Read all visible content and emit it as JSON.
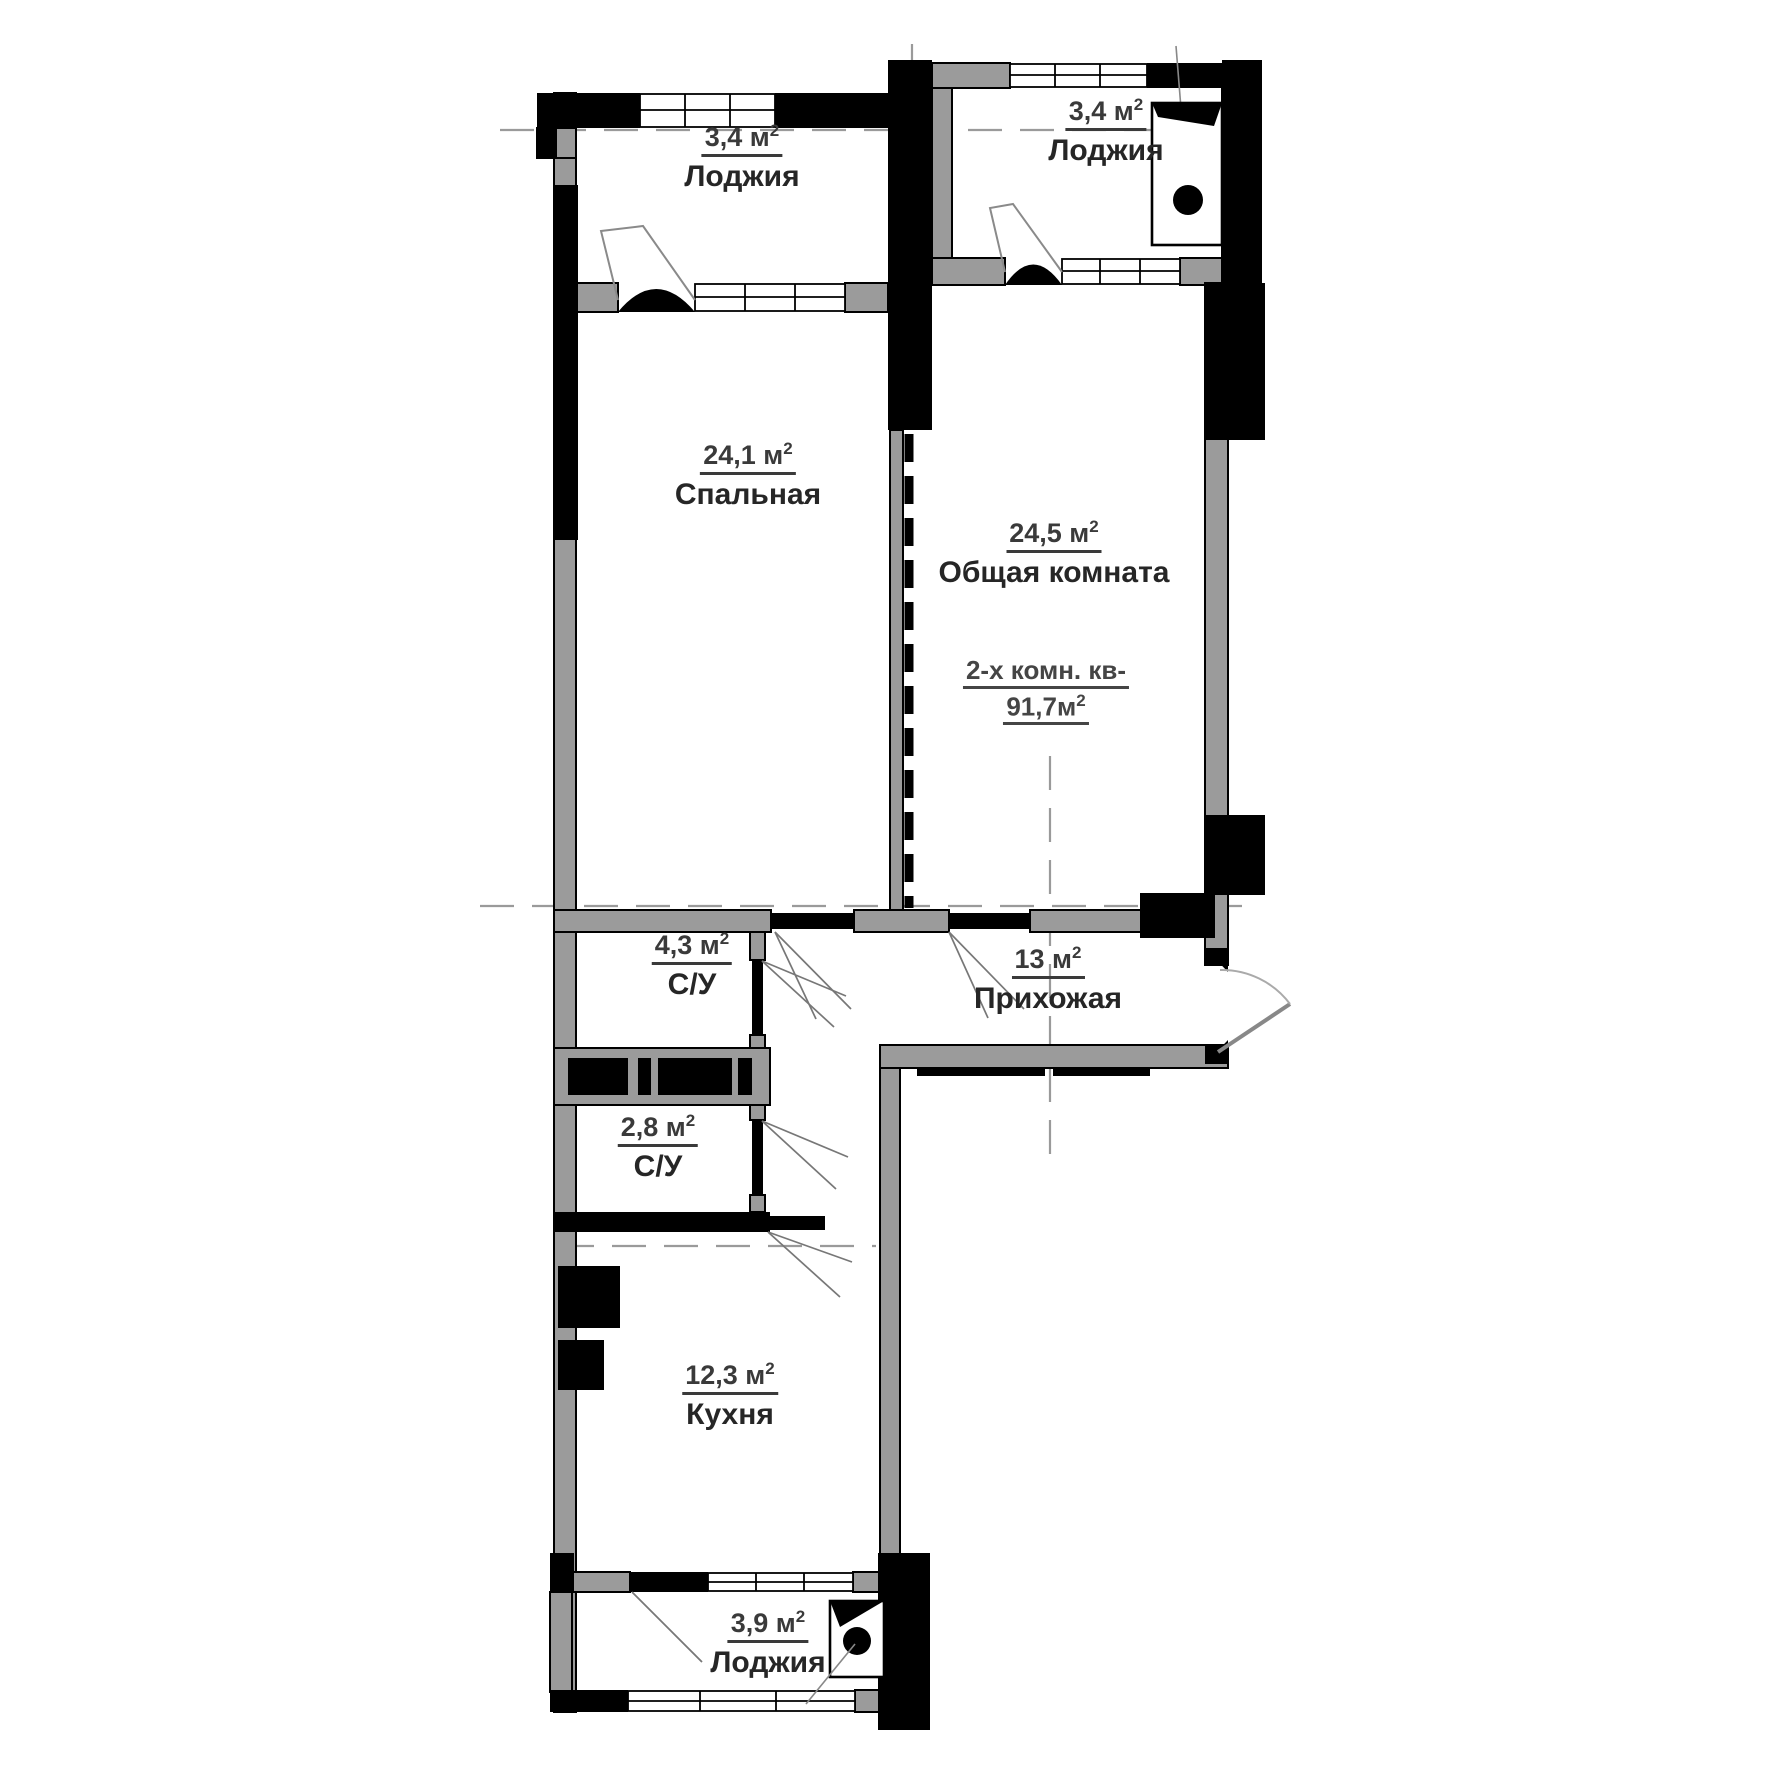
{
  "plan": {
    "colors": {
      "wall_gray": "#9b9b9b",
      "wall_black": "#000000",
      "thin_line": "#777777"
    },
    "apartment_summary": {
      "line1": "2-х комн. кв-",
      "area_label": "91,7м",
      "sup": "2"
    },
    "rooms": [
      {
        "id": "loggia-top-left",
        "area_label": "3,4 м",
        "sup": "2",
        "name": "Лоджия"
      },
      {
        "id": "loggia-top-right",
        "area_label": "3,4 м",
        "sup": "2",
        "name": "Лоджия"
      },
      {
        "id": "bedroom",
        "area_label": "24,1 м",
        "sup": "2",
        "name": "Спальная"
      },
      {
        "id": "living-room",
        "area_label": "24,5 м",
        "sup": "2",
        "name": "Общая комната"
      },
      {
        "id": "bathroom-1",
        "area_label": "4,3 м",
        "sup": "2",
        "name": "С/У"
      },
      {
        "id": "hallway",
        "area_label": "13 м",
        "sup": "2",
        "name": "Прихожая"
      },
      {
        "id": "bathroom-2",
        "area_label": "2,8 м",
        "sup": "2",
        "name": "С/У"
      },
      {
        "id": "kitchen",
        "area_label": "12,3 м",
        "sup": "2",
        "name": "Кухня"
      },
      {
        "id": "loggia-bottom",
        "area_label": "3,9 м",
        "sup": "2",
        "name": "Лоджия"
      }
    ]
  }
}
